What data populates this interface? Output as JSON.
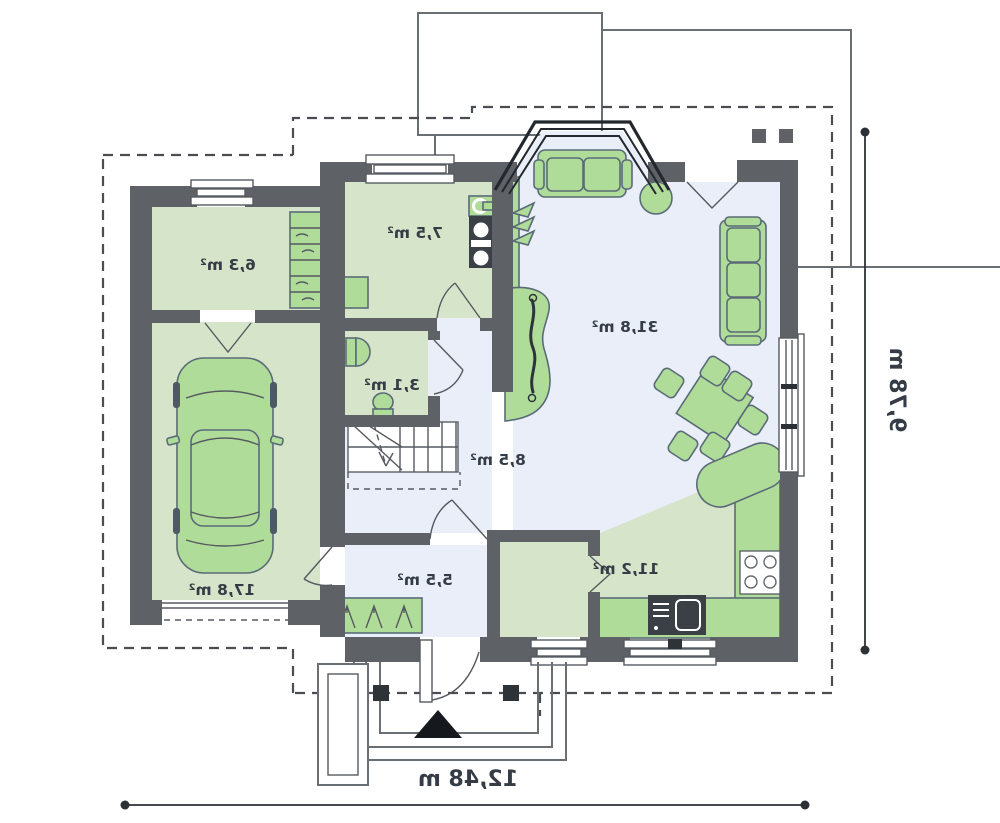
{
  "plan": {
    "type": "floor-plan",
    "mirrored": true,
    "rooms": [
      {
        "name": "garage",
        "area": "17,8 m²"
      },
      {
        "name": "utility-room",
        "area": "6,3 m²"
      },
      {
        "name": "laundry-room",
        "area": "7,5 m²"
      },
      {
        "name": "wc",
        "area": "3,1 m²"
      },
      {
        "name": "hall",
        "area": "8,5 m²"
      },
      {
        "name": "vestibule",
        "area": "5,5 m²"
      },
      {
        "name": "kitchen",
        "area": "11,2 m²"
      },
      {
        "name": "living-room",
        "area": "31,8 m²"
      }
    ],
    "dimensions": {
      "width": "12,48 m",
      "depth": "9,78 m"
    },
    "colors": {
      "wall": "#5e6266",
      "floor_green": "#d6e4c9",
      "floor_blue": "#e9eef8",
      "furniture_green": "#b0dc99",
      "furniture_outline": "#5a6b78"
    }
  }
}
